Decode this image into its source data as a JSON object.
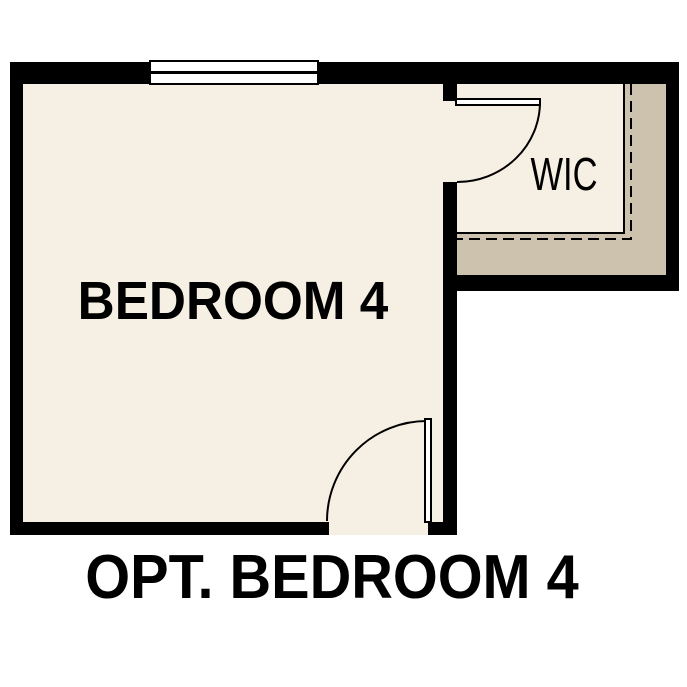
{
  "plan": {
    "caption": "OPT. BEDROOM 4",
    "rooms": [
      {
        "id": "bedroom4",
        "label": "BEDROOM 4"
      },
      {
        "id": "wic",
        "label": "WIC"
      }
    ]
  },
  "colors": {
    "background": "#ffffff",
    "wall": "#000000",
    "floor": "#f6efe3",
    "closet_band": "#ccc2ae",
    "door": "#ffffff"
  }
}
